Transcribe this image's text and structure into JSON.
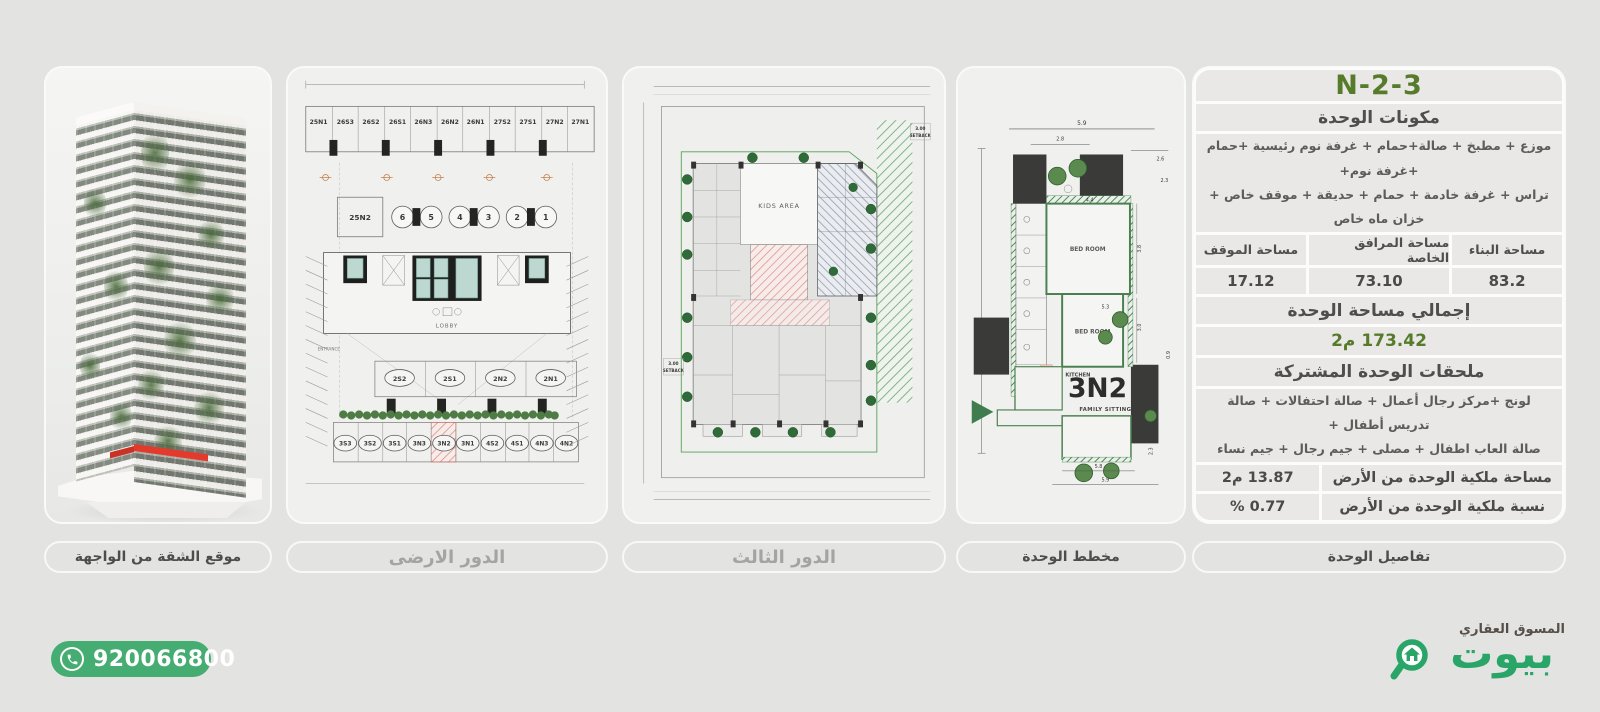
{
  "colors": {
    "brand_green": "#28a567",
    "pill_green": "#45ac72",
    "title_green": "#567b2b",
    "highlight_red": "#e0392e",
    "hatch_pink": "#d99287",
    "hatch_blue": "#8d99ad",
    "wall_green": "#4a8050"
  },
  "panels": {
    "facade": {
      "label": "موقع الشقة من الواجهة"
    },
    "ground": {
      "label": "الدور الارضى"
    },
    "third": {
      "label": "الدور الثالث"
    },
    "unit": {
      "label": "مخطط الوحدة"
    },
    "details": {
      "label": "تفاصيل الوحدة"
    }
  },
  "plans": {
    "ground": {
      "top_stalls": [
        "25N1",
        "26S3",
        "26S2",
        "26S1",
        "26N3",
        "26N2",
        "26N1",
        "27S2",
        "27S1",
        "27N2",
        "27N1"
      ],
      "mid_box": "25N2",
      "numbers": [
        "6",
        "5",
        "4",
        "3",
        "2",
        "1"
      ],
      "lobby": "LOBBY",
      "entrance": "ENTRANCE",
      "row2": [
        "2S2",
        "2S1",
        "2N2",
        "2N1"
      ],
      "bottom_stalls": [
        "3S3",
        "3S2",
        "3S1",
        "3N3",
        "3N2",
        "3N1",
        "4S2",
        "4S1",
        "4N3",
        "4N2"
      ]
    },
    "third": {
      "kids_area": "KIDS AREA",
      "setback_value": "3.00",
      "setback_word": "SETBACK"
    },
    "unit": {
      "unit_id": "3N2",
      "family_sitting": "FAMILY SITTING",
      "kitchen": "KITCHEN",
      "bedroom1": "BED ROOM",
      "bedroom2": "BED ROOM",
      "dims": {
        "top": "5.9",
        "c1": "2.8",
        "r1": "2.6",
        "r2": "2.3",
        "inner": "4.4",
        "r3": "3.8",
        "r4": "3.0",
        "mid": "5.3",
        "r5": "0.9",
        "b1": "2.3",
        "b2": "5.8",
        "b3": "5.9"
      }
    }
  },
  "details": {
    "title": "3-N-2",
    "components_header": "مكونات الوحدة",
    "components_line1": "موزع + مطبخ + صالة+حمام + غرفة نوم رئيسية +حمام +غرفة نوم+",
    "components_line2": "تراس + غرفة خادمة + حمام + حديقة + موقف خاص + خزان ماه خاص",
    "area_table": {
      "headers": [
        "مساحة البناء",
        "مساحة المرافق الخاصة",
        "مساحة الموقف"
      ],
      "values": [
        "83.2",
        "73.10",
        "17.12"
      ]
    },
    "total_header": "إجمالي مساحة الوحدة",
    "total_value": "173.42 م2",
    "shared_header": "ملحقات الوحدة المشتركة",
    "shared_line1": "لونج +مركز رجال أعمال + صالة احتفالات + صالة تدريس أطفال +",
    "shared_line2": "صالة العاب اطفال + مصلى + جيم رجال + جيم نساء",
    "land_rows": [
      {
        "label": "مساحة ملكية الوحدة من الأرض",
        "value": "13.87 م2"
      },
      {
        "label": "نسبة ملكية الوحدة من الأرض",
        "value": "0.77 %"
      }
    ]
  },
  "footer": {
    "phone": "920066800",
    "marketer": "المسوق العقاري",
    "brand": "بيوت"
  }
}
